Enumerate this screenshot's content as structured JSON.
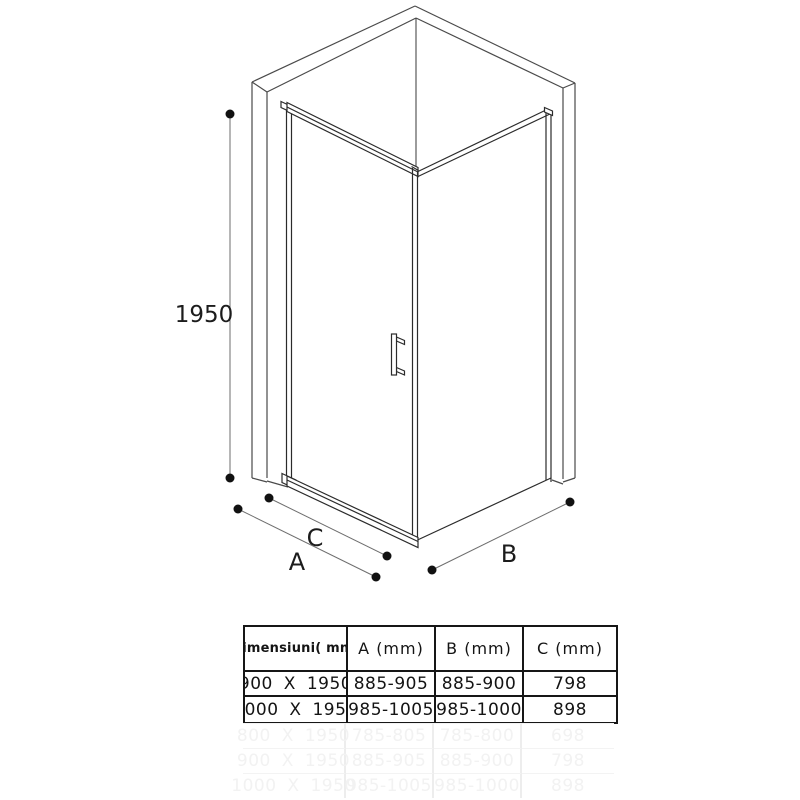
{
  "diagram": {
    "height_label": "1950",
    "depth_label": "B",
    "door_width_label": "A",
    "glass_width_label": "C"
  },
  "table": {
    "headers": [
      "Dimensiuni( mm)",
      "A (mm)",
      "B (mm)",
      "C (mm)"
    ],
    "rows": [
      [
        "900 X 1950",
        "885-905",
        "885-900",
        "798"
      ],
      [
        "1000 X 1950",
        "985-1005",
        "985-1000",
        "898"
      ]
    ],
    "ghost_rows": [
      [
        "800 X 1950",
        "785-805",
        "785-800",
        "698"
      ],
      [
        "900 X 1950",
        "885-905",
        "885-900",
        "798"
      ],
      [
        "1000 X 1950",
        "985-1005",
        "985-1000",
        "898"
      ]
    ]
  },
  "colors": {
    "wall_line": "#4a4a4a",
    "frame_line": "#2b2b2b",
    "dimension_line": "#6e6e6e",
    "dot": "#111111",
    "table_border": "#161616"
  }
}
